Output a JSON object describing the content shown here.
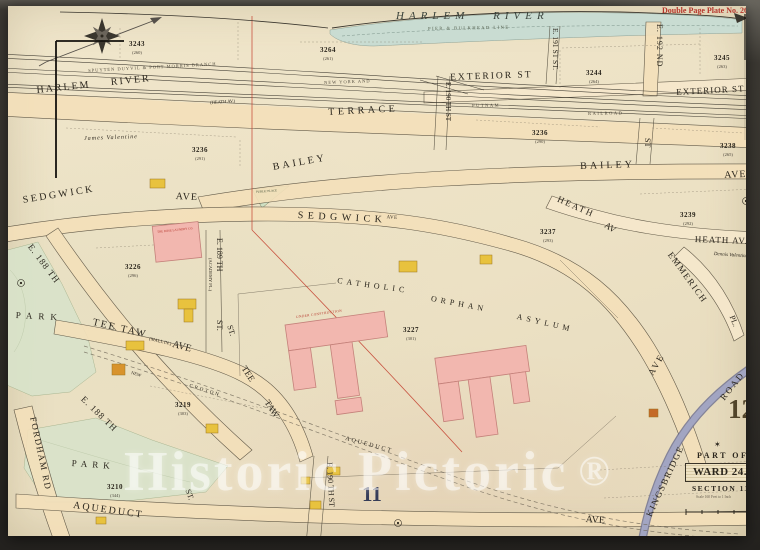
{
  "plate": {
    "title": "Double Page Plate No. 26",
    "page_number_right": "12",
    "page_number_bottom": "11"
  },
  "cartouche": {
    "part_of": "PART OF",
    "ward": "WARD 24.",
    "section": "SECTION 11",
    "scale": "Scale 160 Feet to 1 Inch",
    "star": "✶"
  },
  "water": {
    "name": "HARLEM RIVER",
    "pier_line": "PIER & BULKHEAD LINE"
  },
  "railroad": {
    "branch": "SPUYTEN DUYVIL & PORT MORRIS BRANCH",
    "new_york_and": "NEW YORK AND",
    "putnam": "PUTNAM",
    "railroad": "RAILROAD"
  },
  "streets": {
    "harlem_river": "HARLEM RIVER",
    "heath_paren": "(HEATH AV.)",
    "terrace": "TERRACE",
    "exterior_w": "EXTERIOR ST",
    "exterior_e": "EXTERIOR ST",
    "bailey_w": "BAILEY",
    "bailey_e": "BAILEY",
    "bailey_e_ave": "AVE",
    "sedgwick_w": "SEDGWICK",
    "sedgwick_w_ave": "AVE",
    "sedgwick_c": "SEDGWICK",
    "sedgwick_c_sup": "AVE",
    "sedgwick_s_ave": "AVE",
    "heath_w": "HEATH",
    "heath_w_av": "AV",
    "heath_e": "HEATH AV.",
    "emmerich": "EMMERICH",
    "emmerich_pl": "PL.",
    "kingsbridge": "KINGSBRIDGE",
    "kingsbridge_road": "ROAD",
    "e188_n": "E. 188 TH",
    "e188_s": "E. 188 TH",
    "e189": "E. 189 TH",
    "e189_academy": "(ACADEMY PL.)",
    "e189_st": "ST.",
    "e190_n": "E. 190 TH ST",
    "e190_s": "E. 190 TH ST",
    "e191": "E. 191 ST ST.",
    "e192": "E. 192 ND",
    "st_192": "ST",
    "fordham": "FORDHAM RD",
    "tee_taw": "TEE TAW",
    "tee_taw_mall": "(MALL IN.)",
    "tee_taw_ave": "AVE",
    "tee": "TEE",
    "taw": "TAW",
    "aqueduct_s": "AQUEDUCT",
    "aqueduct_s_ave": "AVE",
    "aqueduct_diag": "AQUEDUCT",
    "new": "NEW",
    "croton": "CROTON",
    "park_n": "PARK",
    "park_s": "PARK",
    "st_a": "ST.",
    "st_b": "ST."
  },
  "owners": {
    "james": "James Valentine",
    "dennis": "Dennis Valentine"
  },
  "landmarks": {
    "catholic": "CATHOLIC",
    "orphan": "ORPHAN",
    "asylum": "ASYLUM",
    "under_construction": "UNDER CONSTRUCTION",
    "laundry": "THE ROSE LAUNDRY CO.",
    "public_place": "PUBLIC PLACE"
  },
  "blocks": [
    {
      "num": "3243",
      "sub": "(260)"
    },
    {
      "num": "3264",
      "sub": "(261)"
    },
    {
      "num": "3244",
      "sub": "(264)"
    },
    {
      "num": "3245",
      "sub": "(263)"
    },
    {
      "num": "3236",
      "sub": "(290)"
    },
    {
      "num": "3238",
      "sub": "(265)"
    },
    {
      "num": "3239",
      "sub": "(292)"
    },
    {
      "num": "3237",
      "sub": "(293)"
    },
    {
      "num": "3236",
      "sub": "(291)"
    },
    {
      "num": "3226",
      "sub": "(296)"
    },
    {
      "num": "3227",
      "sub": "(301)"
    },
    {
      "num": "3219",
      "sub": "(303)"
    },
    {
      "num": "3210",
      "sub": "(344)"
    }
  ],
  "watermark": {
    "text": "Historic Pictoric",
    "reg": "®"
  },
  "palette": {
    "paper": "#ece1c6",
    "street_fill": "#f4e0ba",
    "water": "#c9dcd2",
    "park": "#d9e3ca",
    "building_pink": "#f2b7af",
    "building_yellow": "#e8c23e",
    "road_purple": "#9a9dbd",
    "accent_red": "#b5342a",
    "ink": "#2b261d",
    "backdrop": "#36332d"
  }
}
